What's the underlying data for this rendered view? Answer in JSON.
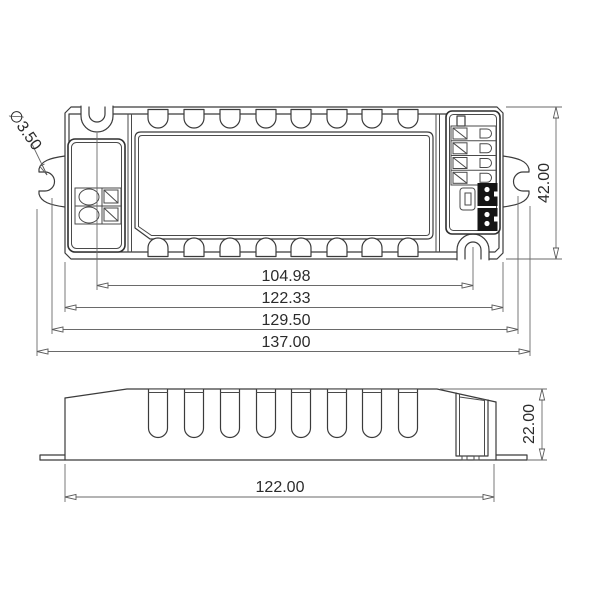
{
  "drawing": {
    "type": "mechanical-dimension-drawing",
    "subject": "LED driver enclosure, top view and side view",
    "colors": {
      "background": "#ffffff",
      "lines": "#3b3b3b",
      "dimensions": "#6a6a6a",
      "connector_fill": "#151515"
    },
    "hole_callout": "∅3.50",
    "top_view": {
      "dim_mount_slot_centers": "104.98",
      "dim_body_width": "122.33",
      "dim_flange_slots": "129.50",
      "dim_overall_width": "137.00",
      "dim_height": "42.00"
    },
    "side_view": {
      "dim_length": "122.00",
      "dim_height": "22.00"
    }
  }
}
